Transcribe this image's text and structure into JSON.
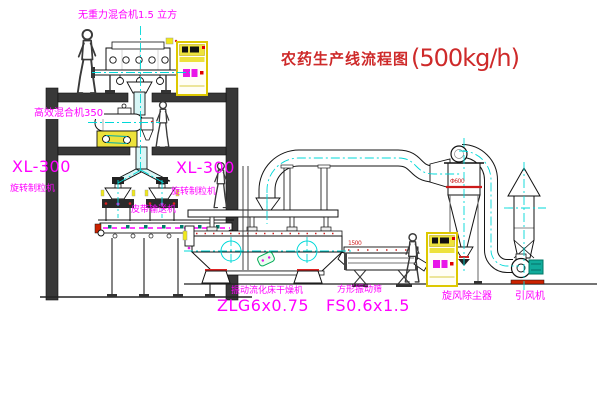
{
  "title": {
    "cn": "农药生产线流程图",
    "capacity": "(500kg/h)"
  },
  "colors": {
    "label_magenta": "#ff00ff",
    "title_red": "#ce2a2a",
    "centerline_cyan": "#00d8d8",
    "cabinet_yellow": "#ede23b",
    "motor_green": "#11ab9b",
    "accent_red": "#d02020",
    "structure_dark": "#383838"
  },
  "labels": {
    "mixer_top": "无重力混合机1.5 立方",
    "mixer_high_eff": "高效混合机350",
    "granulator_left": {
      "model": "XL-300",
      "name": "旋转制粒机"
    },
    "granulator_right": {
      "model": "XL-300",
      "name": "旋转制粒机"
    },
    "belt_conveyor": "皮带输送机",
    "dryer": {
      "name": "振动流化床干燥机",
      "model": "ZLG6x0.75"
    },
    "sieve": {
      "name": "方形振动筛",
      "model": "FS0.6x1.5",
      "dim": "1500"
    },
    "cyclone": {
      "name": "旋风除尘器",
      "dim": "Φ600"
    },
    "fan": {
      "name": "引风机"
    }
  }
}
